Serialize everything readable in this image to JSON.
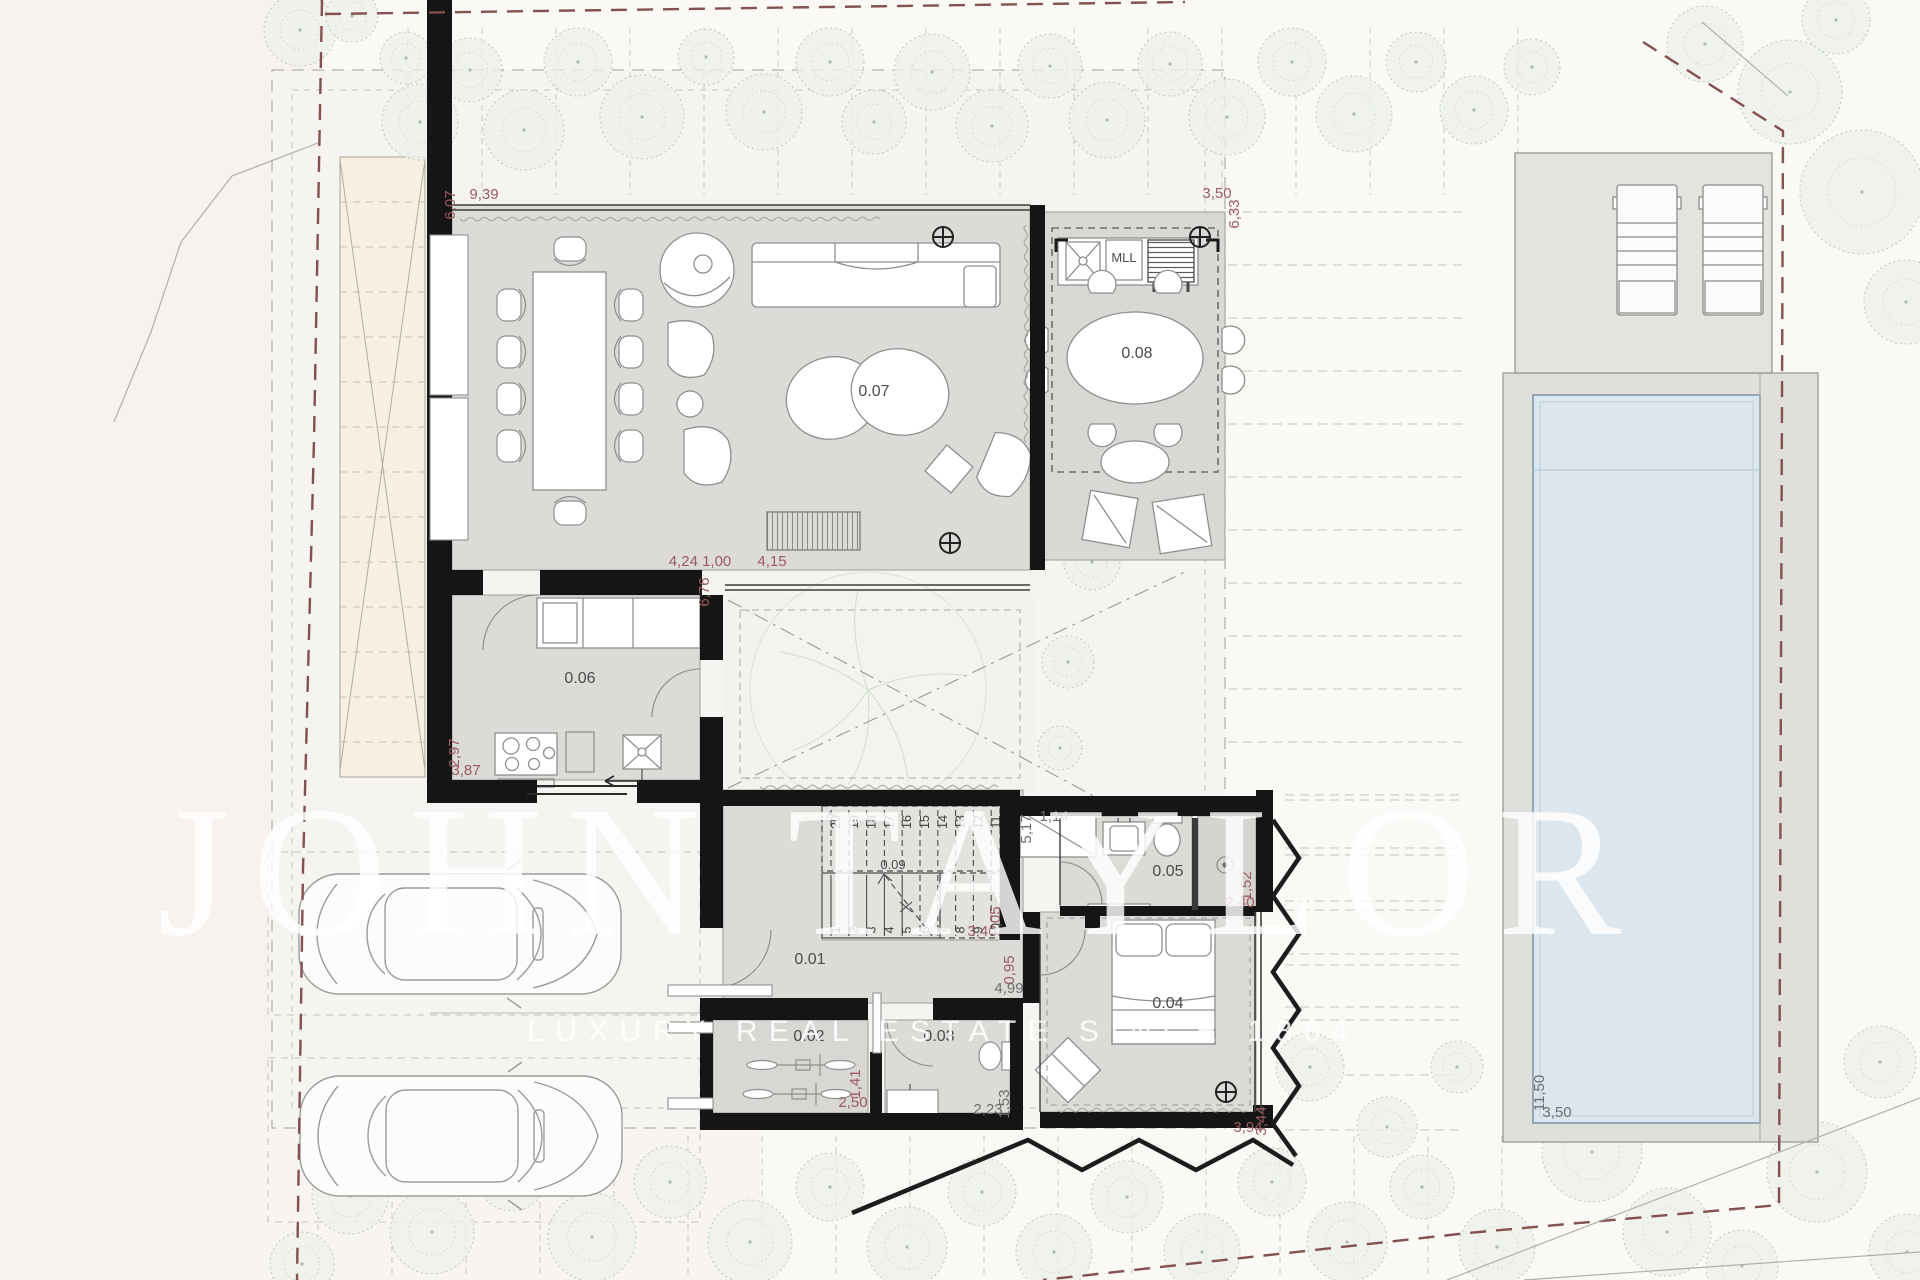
{
  "watermark": {
    "line1": "JOHN TAYLOR",
    "line2": "LUXURY REAL ESTATE SINCE 1864"
  },
  "colors": {
    "dimension_red": "#9b5b60",
    "dimension_dark": "#6e6e6e",
    "label": "#4c4c4c",
    "boundary": "#845050",
    "wall": "#151515",
    "floor": "#dcdbd7",
    "water": "#dce6ee",
    "tree_edge": "#b9c7b5",
    "driveway": "#f7f0e1"
  },
  "room_labels": [
    {
      "t": "0.07",
      "x": 874,
      "y": 396
    },
    {
      "t": "0.08",
      "x": 1137,
      "y": 358
    },
    {
      "t": "0.06",
      "x": 580,
      "y": 683
    },
    {
      "t": "0.09",
      "x": 893,
      "y": 869,
      "s": 13
    },
    {
      "t": "0.01",
      "x": 810,
      "y": 964
    },
    {
      "t": "0.02",
      "x": 809,
      "y": 1041
    },
    {
      "t": "0.03",
      "x": 939,
      "y": 1041
    },
    {
      "t": "0.05",
      "x": 1168,
      "y": 876
    },
    {
      "t": "0.04",
      "x": 1168,
      "y": 1008
    },
    {
      "t": "MLL",
      "x": 1124,
      "y": 262,
      "s": 13
    }
  ],
  "dimensions": [
    {
      "t": "6,07",
      "x": 455,
      "y": 205,
      "v": true,
      "c": "red"
    },
    {
      "t": "9,39",
      "x": 484,
      "y": 199,
      "c": "red"
    },
    {
      "t": "3,50",
      "x": 1217,
      "y": 198,
      "c": "red"
    },
    {
      "t": "6,33",
      "x": 1239,
      "y": 214,
      "v": true,
      "c": "red"
    },
    {
      "t": "4,24 1,00",
      "x": 700,
      "y": 566,
      "c": "red"
    },
    {
      "t": "4,15",
      "x": 772,
      "y": 566,
      "c": "red"
    },
    {
      "t": "6,76",
      "x": 709,
      "y": 592,
      "v": true,
      "c": "red"
    },
    {
      "t": "2,97",
      "x": 459,
      "y": 753,
      "v": true,
      "c": "red"
    },
    {
      "t": "3,87",
      "x": 466,
      "y": 775,
      "c": "red"
    },
    {
      "t": "5,17",
      "x": 1031,
      "y": 829,
      "v": true,
      "c": "dark"
    },
    {
      "t": "1,14",
      "x": 1054,
      "y": 821,
      "c": "dark"
    },
    {
      "t": "3,46",
      "x": 982,
      "y": 936,
      "c": "red"
    },
    {
      "t": "2,05",
      "x": 1000,
      "y": 921,
      "v": true,
      "c": "red"
    },
    {
      "t": "0,95",
      "x": 1014,
      "y": 970,
      "v": true,
      "c": "red"
    },
    {
      "t": "4,99",
      "x": 1009,
      "y": 993,
      "c": "dark"
    },
    {
      "t": "1,41",
      "x": 860,
      "y": 1084,
      "v": true,
      "c": "red"
    },
    {
      "t": "2,50",
      "x": 853,
      "y": 1107,
      "c": "red"
    },
    {
      "t": "2,23",
      "x": 988,
      "y": 1114,
      "c": "dark"
    },
    {
      "t": "1,53",
      "x": 1009,
      "y": 1104,
      "v": true,
      "c": "dark"
    },
    {
      "t": "2,40",
      "x": 1240,
      "y": 907,
      "c": "red"
    },
    {
      "t": "1,52",
      "x": 1251,
      "y": 886,
      "v": true,
      "c": "red"
    },
    {
      "t": "3,94",
      "x": 1248,
      "y": 1132,
      "c": "red"
    },
    {
      "t": "3,44",
      "x": 1266,
      "y": 1121,
      "v": true,
      "c": "red"
    },
    {
      "t": "11,50",
      "x": 1544,
      "y": 1093,
      "v": true,
      "c": "dark"
    },
    {
      "t": "3,50",
      "x": 1557,
      "y": 1117,
      "c": "dark"
    }
  ],
  "stairs": {
    "upper": [
      "20",
      "19",
      "18",
      "17",
      "16",
      "15",
      "14",
      "13",
      "12",
      "11"
    ],
    "lower": [
      "1",
      "2",
      "3",
      "4",
      "5",
      "6",
      "7",
      "8",
      "9",
      "10"
    ]
  },
  "markers": [
    {
      "x": 943,
      "y": 237
    },
    {
      "x": 1200,
      "y": 237
    },
    {
      "x": 950,
      "y": 543
    },
    {
      "x": 1226,
      "y": 1092
    }
  ],
  "trees": [
    [
      300,
      30,
      36
    ],
    [
      352,
      16,
      26
    ],
    [
      406,
      58,
      26
    ],
    [
      420,
      122,
      38
    ],
    [
      470,
      70,
      32
    ],
    [
      524,
      130,
      40
    ],
    [
      578,
      62,
      34
    ],
    [
      642,
      117,
      42
    ],
    [
      706,
      57,
      28
    ],
    [
      764,
      112,
      38
    ],
    [
      830,
      62,
      34
    ],
    [
      874,
      122,
      32
    ],
    [
      932,
      72,
      38
    ],
    [
      992,
      126,
      36
    ],
    [
      1050,
      66,
      32
    ],
    [
      1107,
      120,
      38
    ],
    [
      1170,
      64,
      32
    ],
    [
      1227,
      117,
      38
    ],
    [
      1292,
      62,
      34
    ],
    [
      1354,
      114,
      38
    ],
    [
      1416,
      62,
      30
    ],
    [
      1474,
      110,
      34
    ],
    [
      1532,
      67,
      28
    ],
    [
      1705,
      44,
      38
    ],
    [
      1790,
      92,
      52
    ],
    [
      1862,
      192,
      62
    ],
    [
      1906,
      302,
      42
    ],
    [
      1836,
      20,
      34
    ],
    [
      1012,
      507,
      34
    ],
    [
      1092,
      562,
      28
    ],
    [
      1068,
      662,
      26
    ],
    [
      1060,
      748,
      22
    ],
    [
      350,
      1196,
      38
    ],
    [
      302,
      1264,
      32
    ],
    [
      432,
      1232,
      42
    ],
    [
      512,
      1177,
      34
    ],
    [
      592,
      1237,
      44
    ],
    [
      670,
      1182,
      36
    ],
    [
      750,
      1242,
      42
    ],
    [
      830,
      1187,
      34
    ],
    [
      907,
      1247,
      40
    ],
    [
      982,
      1192,
      34
    ],
    [
      1054,
      1252,
      38
    ],
    [
      1127,
      1197,
      36
    ],
    [
      1202,
      1252,
      38
    ],
    [
      1272,
      1182,
      34
    ],
    [
      1347,
      1242,
      40
    ],
    [
      1422,
      1187,
      32
    ],
    [
      1497,
      1247,
      38
    ],
    [
      1310,
      1067,
      34
    ],
    [
      1387,
      1127,
      30
    ],
    [
      1457,
      1067,
      26
    ],
    [
      1592,
      1152,
      50
    ],
    [
      1667,
      1232,
      44
    ],
    [
      1747,
      1092,
      40
    ],
    [
      1817,
      1172,
      50
    ],
    [
      1880,
      1062,
      36
    ],
    [
      1907,
      1252,
      38
    ],
    [
      1742,
      1266,
      36
    ]
  ]
}
